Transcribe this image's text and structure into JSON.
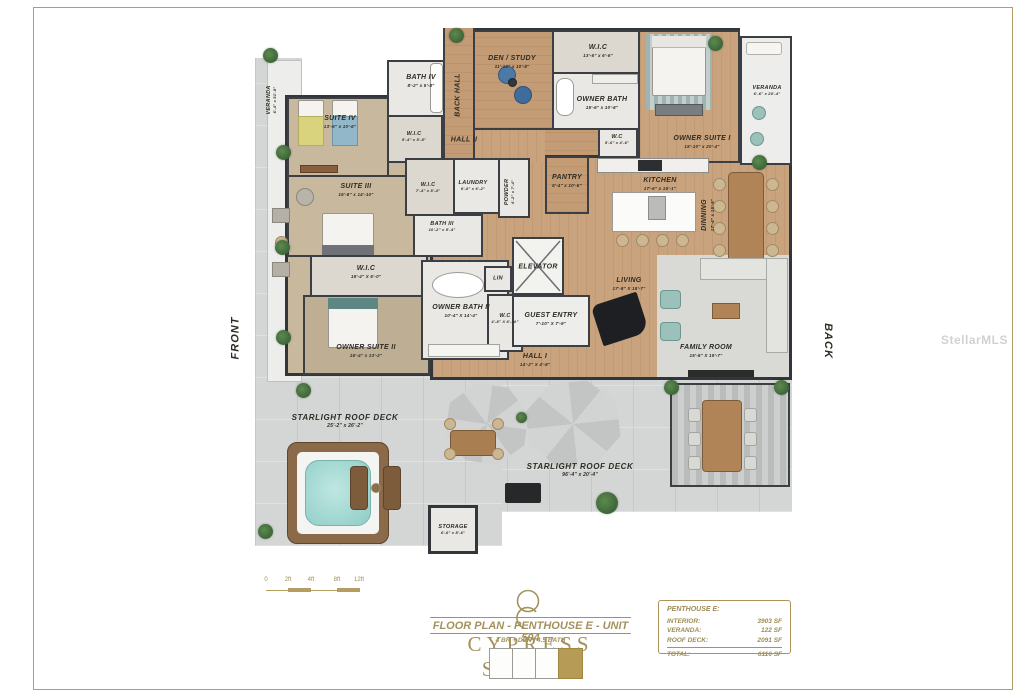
{
  "watermark": "StellarMLS",
  "orientation": {
    "front": "FRONT",
    "back": "BACK"
  },
  "rooms": [
    {
      "name": "SUITE IV",
      "dims": "13'-6\" x 10'-6\""
    },
    {
      "name": "BATH IV",
      "dims": "8'-2\" x 5'-8\""
    },
    {
      "name": "W.I.C",
      "dims": "5'-4\" x 5'-8\""
    },
    {
      "name": "DEN / STUDY",
      "dims": "11'-10\" x 10'-8\""
    },
    {
      "name": "BACK HALL",
      "dims": ""
    },
    {
      "name": "W.I.C",
      "dims": "13'-6\" x 6'-6\""
    },
    {
      "name": "OWNER BATH",
      "dims": "15'-6\" x 10'-8\""
    },
    {
      "name": "W.C",
      "dims": "5'-6\" x 4'-6\""
    },
    {
      "name": "OWNER SUITE I",
      "dims": "15'-10\" x 20'-4\""
    },
    {
      "name": "VERANDA",
      "dims": "6'-6\" x 20'-4\""
    },
    {
      "name": "HALL II",
      "dims": ""
    },
    {
      "name": "SUITE III",
      "dims": "16'-8\" x 14'-10\""
    },
    {
      "name": "W.I.C",
      "dims": "7'-4\" x 5'-4\""
    },
    {
      "name": "LAUNDRY",
      "dims": "6'-8\" x 6'-2\""
    },
    {
      "name": "POWDER",
      "dims": "4'-2\" x 7'-4\""
    },
    {
      "name": "PANTRY",
      "dims": "5'-4\" x 10'-6\""
    },
    {
      "name": "KITCHEN",
      "dims": "17'-6\" x 15'-1\""
    },
    {
      "name": "DINNING",
      "dims": "17'-4\" x 15'-5\""
    },
    {
      "name": "BATH III",
      "dims": "10'-2\" x 5'-4\""
    },
    {
      "name": "W.I.C",
      "dims": "18'-4\" X 6'-0\""
    },
    {
      "name": "OWNER SUITE II",
      "dims": "16'-4\" x 13'-2\""
    },
    {
      "name": "OWNER BATH II",
      "dims": "10'-4\" X 14'-4\""
    },
    {
      "name": "W.C",
      "dims": "4'-8\" X 6'-10\""
    },
    {
      "name": "LIN",
      "dims": ""
    },
    {
      "name": "ELEVATOR",
      "dims": ""
    },
    {
      "name": "GUEST ENTRY",
      "dims": "7'-10\" X 7'-9\""
    },
    {
      "name": "HALL I",
      "dims": "14'-2\" X 4'-8\""
    },
    {
      "name": "LIVING",
      "dims": "17'-8\" X 18'-7\""
    },
    {
      "name": "FAMILY ROOM",
      "dims": "15'-8\" X 19'-7\""
    },
    {
      "name": "STARLIGHT ROOF DECK",
      "dims": "25'-2\" x 26'-2\""
    },
    {
      "name": "STARLIGHT ROOF DECK",
      "dims": "96'-4\" x 20'-4\""
    },
    {
      "name": "STORAGE",
      "dims": "6'-6\" x 8'-6\""
    },
    {
      "name": "VERANDA",
      "dims": "6'-4\" x 51'-8\""
    }
  ],
  "title_block": {
    "brand": "CYPRESS SOUND",
    "plan_title": "FLOOR PLAN - PENTHOUSE E - UNIT 504",
    "subtitle": "4 BR + DEN / 4.5 BATH"
  },
  "area_table": {
    "header": "PENTHOUSE E:",
    "rows": [
      {
        "label": "INTERIOR:",
        "value": "3903 SF"
      },
      {
        "label": "VERANDA:",
        "value": "122 SF"
      },
      {
        "label": "ROOF DECK:",
        "value": "2091 SF"
      }
    ],
    "total": {
      "label": "TOTAL:",
      "value": "6116 SF"
    }
  },
  "scale_bar": {
    "ticks": [
      "0",
      "2ft",
      "4ft",
      "8ft",
      "12ft"
    ]
  },
  "colors": {
    "brand_gold": "#a3925c",
    "wall": "#3b3f44",
    "wood_floor": "#c9a37e",
    "carpet": "#c7b89e",
    "deck": "#d4d6d5"
  }
}
